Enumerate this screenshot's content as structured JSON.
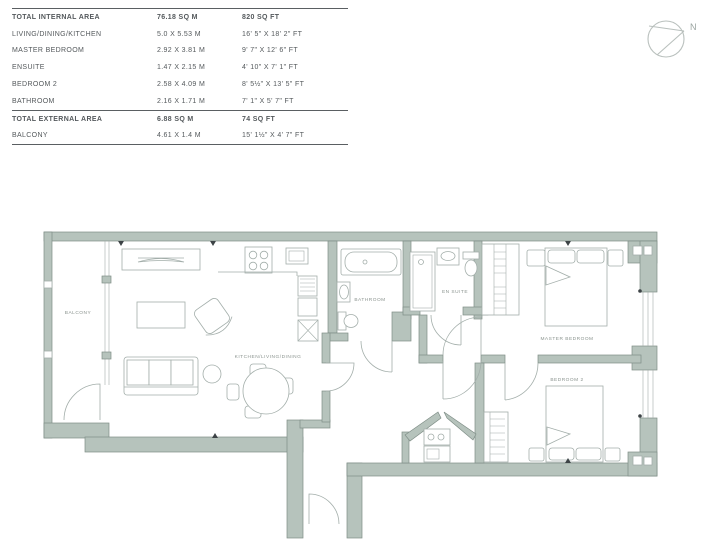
{
  "area_table": {
    "rows": [
      {
        "name": "TOTAL INTERNAL AREA",
        "metric": "76.18 sq m",
        "imperial": "820 sq ft"
      },
      {
        "name": "LIVING/DINING/KITCHEN",
        "metric": "5.0 x 5.53 m",
        "imperial": "16' 5\" x 18' 2\" ft"
      },
      {
        "name": "MASTER BEDROOM",
        "metric": "2.92 x 3.81 m",
        "imperial": "9' 7\" x 12' 6\" ft"
      },
      {
        "name": "ENSUITE",
        "metric": "1.47 x 2.15 m",
        "imperial": "4' 10\" x 7' 1\" ft"
      },
      {
        "name": "BEDROOM 2",
        "metric": "2.58 x 4.09 m",
        "imperial": "8' 5½\" x 13' 5\" ft"
      },
      {
        "name": "BATHROOM",
        "metric": "2.16 x 1.71 m",
        "imperial": "7' 1\" x 5' 7\" ft"
      },
      {
        "name": "TOTAL EXTERNAL AREA",
        "metric": "6.88 sq m",
        "imperial": "74 sq ft"
      },
      {
        "name": "BALCONY",
        "metric": "4.61 x 1.4 m",
        "imperial": "15' 1½\" x 4' 7\" ft"
      }
    ]
  },
  "compass": {
    "label": "N"
  },
  "plan": {
    "labels": {
      "balcony": "BALCONY",
      "kitchen": "KITCHEN/LIVING/DINING",
      "bathroom": "BATHROOM",
      "ensuite": "EN SUITE",
      "master": "MASTER BEDROOM",
      "bedroom2": "BEDROOM 2"
    }
  },
  "colors": {
    "wall_fill": "#b6c3bc",
    "wall_outline": "#7f8e87",
    "fixture_line": "#a3aeaa",
    "plan_label_text": "#8b948f",
    "table_text": "#54595c",
    "table_rule": "#5a5f62",
    "compass_stroke": "#b9c0bd"
  }
}
